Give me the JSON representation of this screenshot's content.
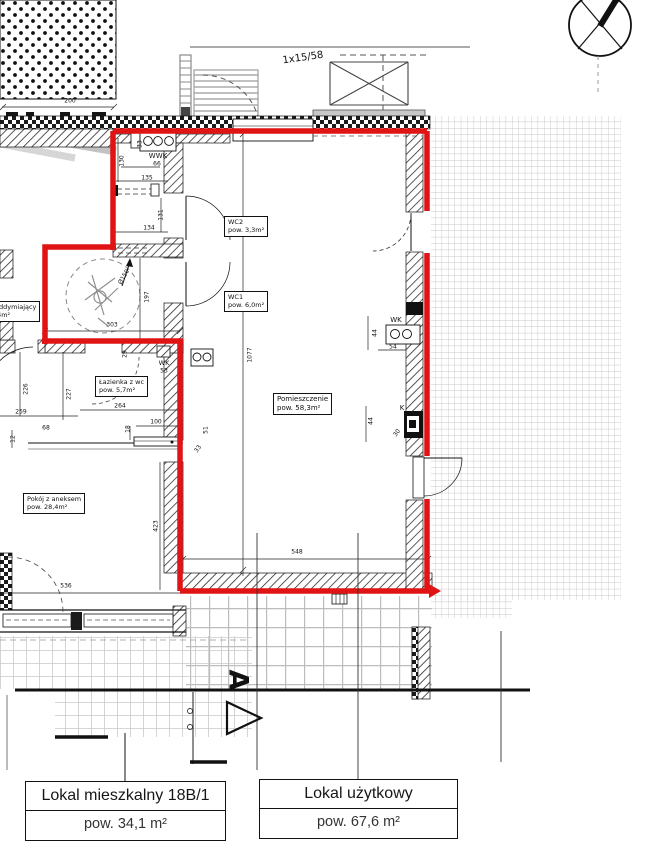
{
  "legend": {
    "units": [
      {
        "title": "Lokal mieszkalny 18B/1",
        "area": "pow. 34,1 m²"
      },
      {
        "title": "Lokal użytkowy",
        "area": "pow. 67,6 m²"
      }
    ]
  },
  "rooms": [
    {
      "name": "WC2",
      "area": "pow. 3,3m²"
    },
    {
      "name": "WC1",
      "area": "pow. 6,0m²"
    },
    {
      "name": "Łazienka z wc",
      "area": "pow. 5,7m²"
    },
    {
      "name": "Pomieszczenie",
      "area": "pow. 58,3m²"
    },
    {
      "name": "Pokój z aneksem",
      "area": "pow. 28,4m²"
    },
    {
      "name": "oddymiający",
      "area": ",4m²"
    }
  ],
  "annotations": {
    "stair_note": "1x15/58",
    "wwk": "WWK",
    "wk_bath": "WK",
    "wk_right": "WK",
    "k_right": "K",
    "section_letter": "A",
    "turning_circle": "Ø150"
  },
  "dimensions": [
    {
      "text": "200"
    },
    {
      "text": "33"
    },
    {
      "text": "130"
    },
    {
      "text": "66"
    },
    {
      "text": "135"
    },
    {
      "text": "134"
    },
    {
      "text": "131"
    },
    {
      "text": "197"
    },
    {
      "text": "303"
    },
    {
      "text": "1077"
    },
    {
      "text": "226"
    },
    {
      "text": "227"
    },
    {
      "text": "259"
    },
    {
      "text": "68"
    },
    {
      "text": "12"
    },
    {
      "text": "264"
    },
    {
      "text": "100"
    },
    {
      "text": "18"
    },
    {
      "text": "33"
    },
    {
      "text": "51"
    },
    {
      "text": "29"
    },
    {
      "text": "53"
    },
    {
      "text": "44"
    },
    {
      "text": "54"
    },
    {
      "text": "44"
    },
    {
      "text": "30"
    },
    {
      "text": "423"
    },
    {
      "text": "536"
    },
    {
      "text": "548"
    }
  ],
  "colors": {
    "boundary_red": "#e01414",
    "line": "#1b1b1b",
    "grid_gray": "#c7c7c7"
  }
}
